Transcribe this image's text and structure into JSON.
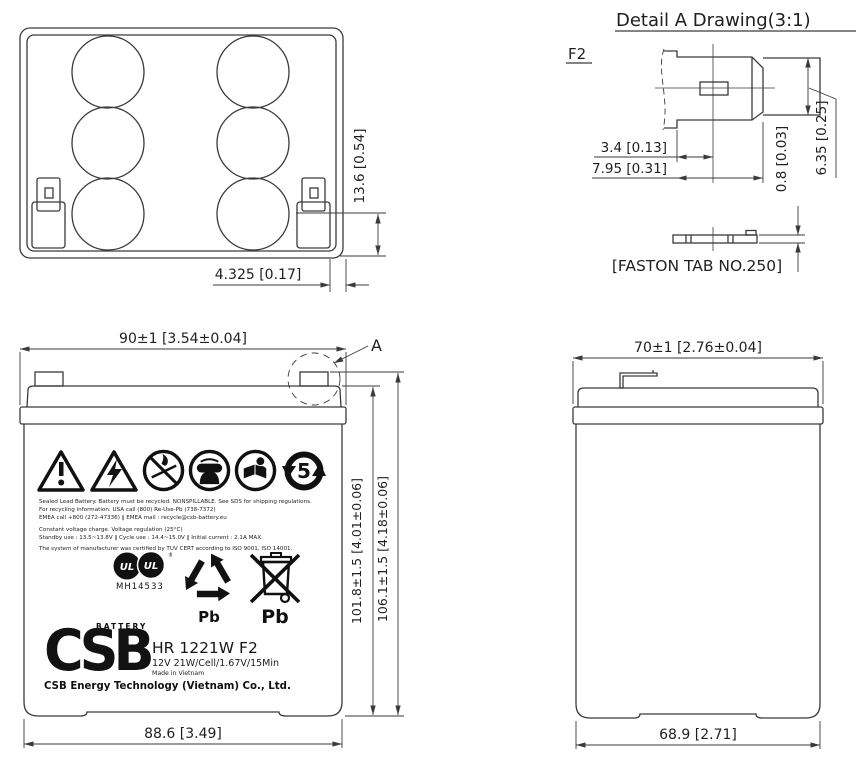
{
  "views": {
    "top": {
      "dim_terminal_height": "13.6 [0.54]",
      "dim_terminal_offset": "4.325 [0.17]"
    },
    "front": {
      "marker": "A",
      "dim_width": "90±1 [3.54±0.04]",
      "dim_case_height": "101.8±1.5 [4.01±0.06]",
      "dim_total_height": "106.1±1.5 [4.18±0.06]",
      "dim_bottom_width": "88.6 [3.49]"
    },
    "side": {
      "dim_width": "70±1 [2.76±0.04]",
      "dim_bottom_width": "68.9 [2.71]"
    },
    "detail": {
      "heading": "Detail A Drawing(3:1)",
      "terminal_code": "F2",
      "dim_offset_center": "3.4 [0.13]",
      "dim_tab_length": "7.95 [0.31]",
      "dim_tab_thickness": "0.8 [0.03]",
      "dim_tab_width": "6.35 [0.25]",
      "caption": "[FASTON TAB NO.250]"
    }
  },
  "battery_label": {
    "notice_line1": "Sealed Lead Battery. Battery must be recycled. NONSPILLABLE. See SDS for shipping regulations.",
    "notice_line2": "For recycling information: USA call (800) Re-Use-Pb (738-7372)",
    "notice_line3": "EMEA call +800 (272-47336)  ‖  EMEA mail : recycle@csb-battery.eu",
    "charge_line1": "Constant voltage charge. Voltage regulation (25°C)",
    "charge_line2": "Standby use : 13.5~13.8V  ‖  Cycle use : 14.4~15.0V  ‖  Initial current : 2.1A MAX.",
    "cert_line": "The system of manufacturer was certified by TUV CERT according to ISO 9001, ISO 14001.",
    "ul_file_number": "MH14533",
    "recycle_pb": "Pb",
    "bin_pb": "Pb",
    "rohs_years": "5",
    "brand_tagline": "BATTERY",
    "brand": "CSB",
    "model": "HR 1221W F2",
    "spec": "12V 21W/Cell/1.67V/15Min",
    "origin": "Made in Vietnam",
    "company": "CSB Energy Technology (Vietnam) Co., Ltd."
  },
  "colors": {
    "line": "#3a3a3a",
    "text": "#1f1f1f",
    "background": "#ffffff"
  }
}
